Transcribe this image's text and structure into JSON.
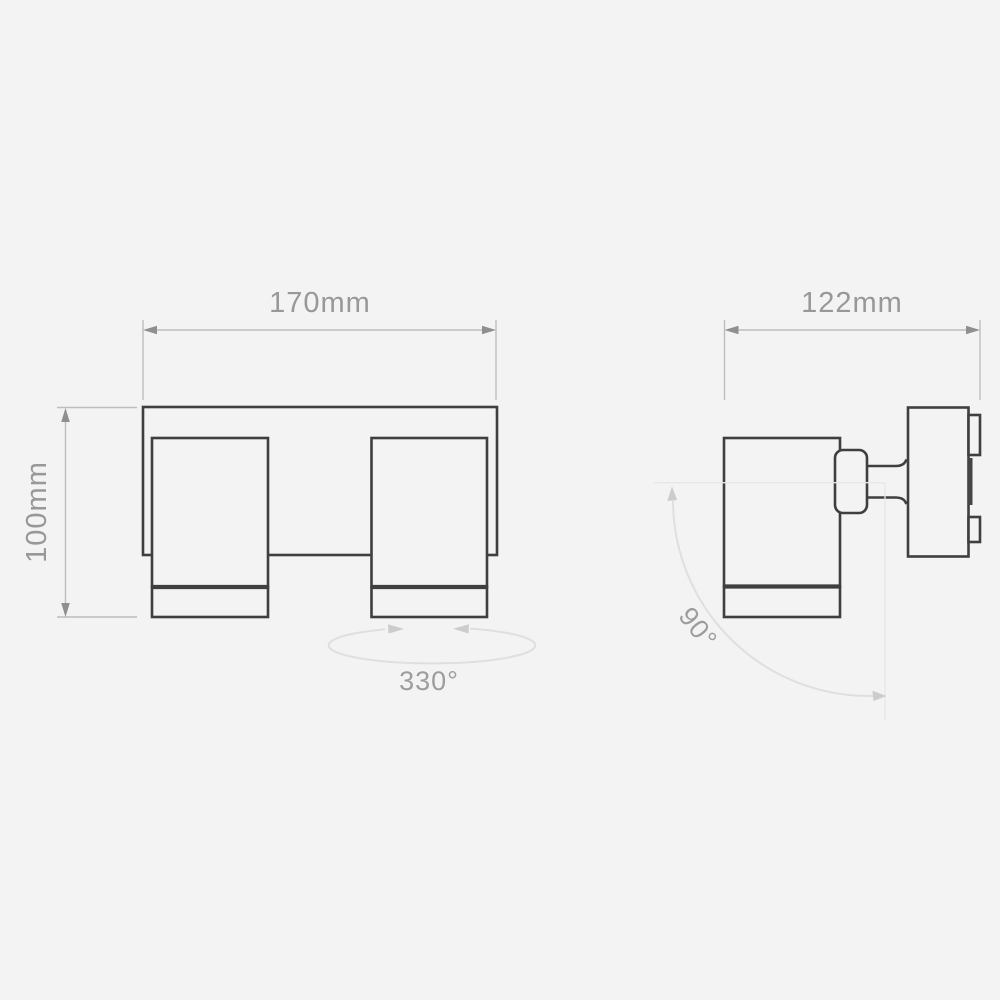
{
  "colors": {
    "background": "#f3f3f3",
    "outline": "#3f3f3f",
    "dimension_line": "#bdbdbd",
    "dimension_arrow": "#8f8f8f",
    "dimension_text": "#989898",
    "annotation_line": "#dfdfdf",
    "annotation_arrow": "#cccccc",
    "reference_line": "#e7e7e7"
  },
  "front_view": {
    "width_label": "170mm",
    "height_label": "100mm",
    "rotation_label": "330°"
  },
  "side_view": {
    "depth_label": "122mm",
    "tilt_label": "90°"
  }
}
